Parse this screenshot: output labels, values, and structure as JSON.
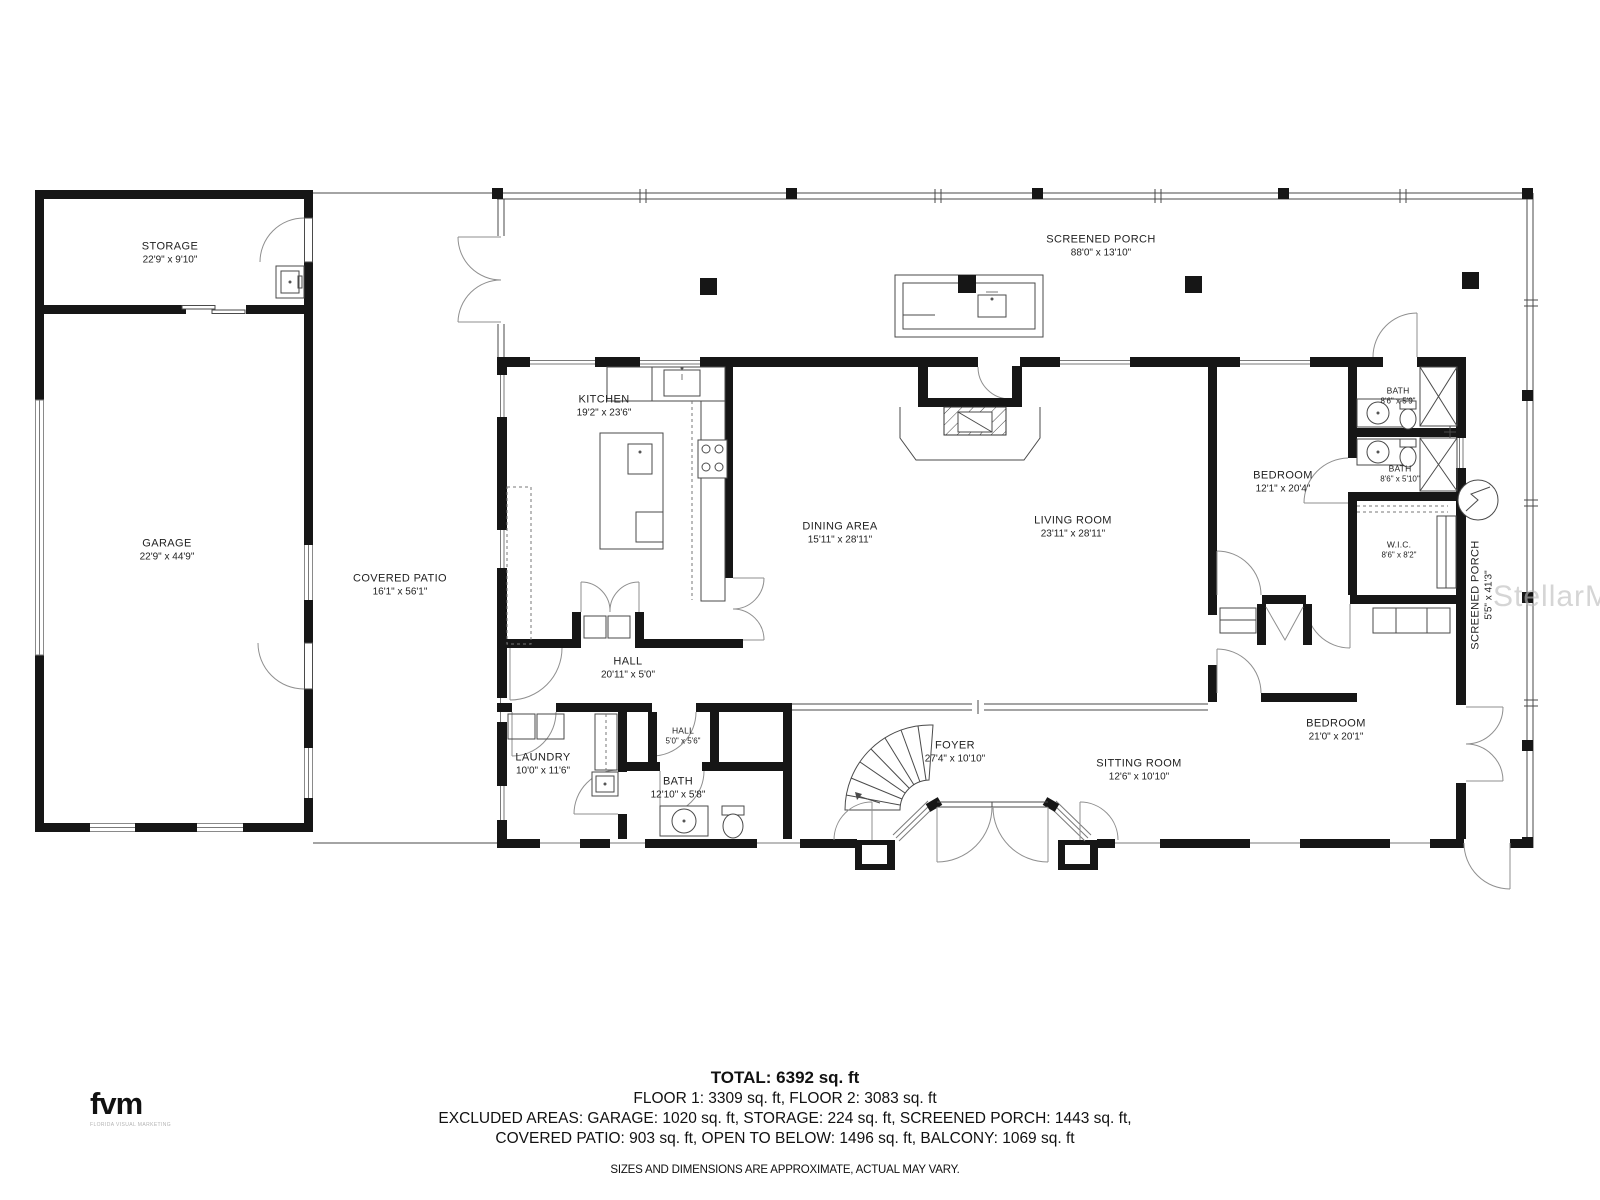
{
  "watermark": "StellarMLS",
  "branding": {
    "logo": "fvm",
    "tagline": "FLORIDA VISUAL MARKETING"
  },
  "rooms": {
    "storage": {
      "name": "STORAGE",
      "dims": "22'9\" x 9'10\""
    },
    "garage": {
      "name": "GARAGE",
      "dims": "22'9\" x 44'9\""
    },
    "covered_patio": {
      "name": "COVERED PATIO",
      "dims": "16'1\" x 56'1\""
    },
    "screened_porch_top": {
      "name": "SCREENED PORCH",
      "dims": "88'0\" x 13'10\""
    },
    "screened_porch_right": {
      "name": "SCREENED PORCH",
      "dims": "5'5\" x 41'3\""
    },
    "kitchen": {
      "name": "KITCHEN",
      "dims": "19'2\" x 23'6\""
    },
    "dining": {
      "name": "DINING AREA",
      "dims": "15'11\" x 28'11\""
    },
    "living": {
      "name": "LIVING ROOM",
      "dims": "23'11\" x 28'11\""
    },
    "bedroom1": {
      "name": "BEDROOM",
      "dims": "12'1\" x 20'4\""
    },
    "bath1": {
      "name": "BATH",
      "dims": "8'6\" x 5'9\""
    },
    "bath2": {
      "name": "BATH",
      "dims": "8'6\" x 5'10\""
    },
    "wic": {
      "name": "W.I.C.",
      "dims": "8'6\" x 8'2\""
    },
    "hall": {
      "name": "HALL",
      "dims": "20'11\" x 5'0\""
    },
    "hall2": {
      "name": "HALL",
      "dims": "5'0\" x 5'6\""
    },
    "laundry": {
      "name": "LAUNDRY",
      "dims": "10'0\" x 11'6\""
    },
    "bath3": {
      "name": "BATH",
      "dims": "12'10\" x 5'8\""
    },
    "foyer": {
      "name": "FOYER",
      "dims": "27'4\" x 10'10\""
    },
    "sitting": {
      "name": "SITTING ROOM",
      "dims": "12'6\" x 10'10\""
    },
    "bedroom2": {
      "name": "BEDROOM",
      "dims": "21'0\" x 20'1\""
    }
  },
  "summary": {
    "total": "TOTAL: 6392 sq. ft",
    "floors": "FLOOR 1: 3309 sq. ft, FLOOR 2: 3083 sq. ft",
    "excluded_line1": "EXCLUDED AREAS: GARAGE: 1020 sq. ft, STORAGE: 224 sq. ft, SCREENED PORCH: 1443 sq. ft,",
    "excluded_line2": "COVERED PATIO: 903 sq. ft, OPEN TO BELOW: 1496 sq. ft, BALCONY: 1069 sq. ft",
    "disclaimer": "SIZES AND DIMENSIONS ARE APPROXIMATE, ACTUAL MAY VARY."
  }
}
